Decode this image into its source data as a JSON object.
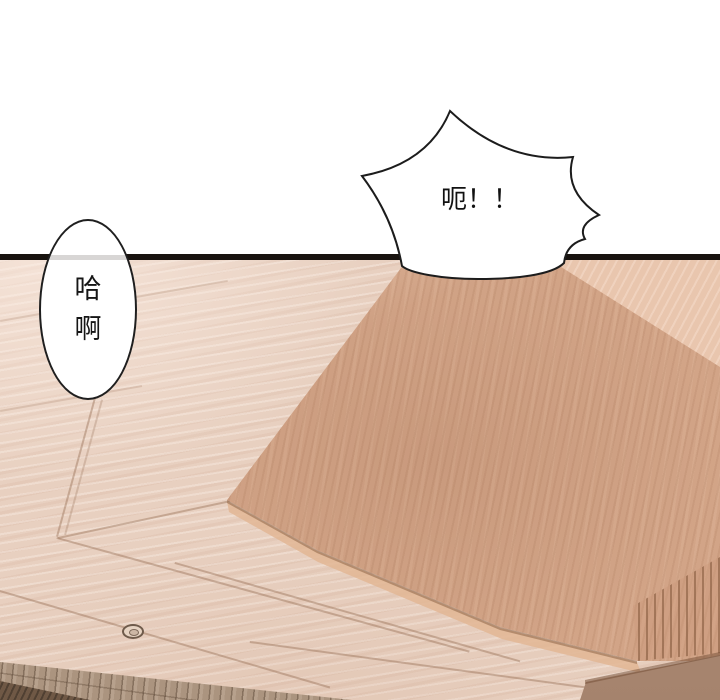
{
  "page": {
    "kind_label": "comic-panel",
    "background_color": "#ffffff",
    "panel_border_color": "#18130f"
  },
  "speech_bubbles": {
    "burst": {
      "text": "呃！！"
    },
    "oval": {
      "line1": "哈",
      "line2": "啊"
    }
  },
  "scene": {
    "floor_base_color": "#e8d0c0",
    "wood_panel_color": "#d2a487",
    "upper_right_wood_color": "#e9c6ae",
    "corner_wood_color": "#ae8b74",
    "brick_color": "#ab947f",
    "dark_corner_color": "#6f5845",
    "bubble_fill_color": "#ffffff",
    "bubble_outline_color": "#1f1f1f"
  }
}
